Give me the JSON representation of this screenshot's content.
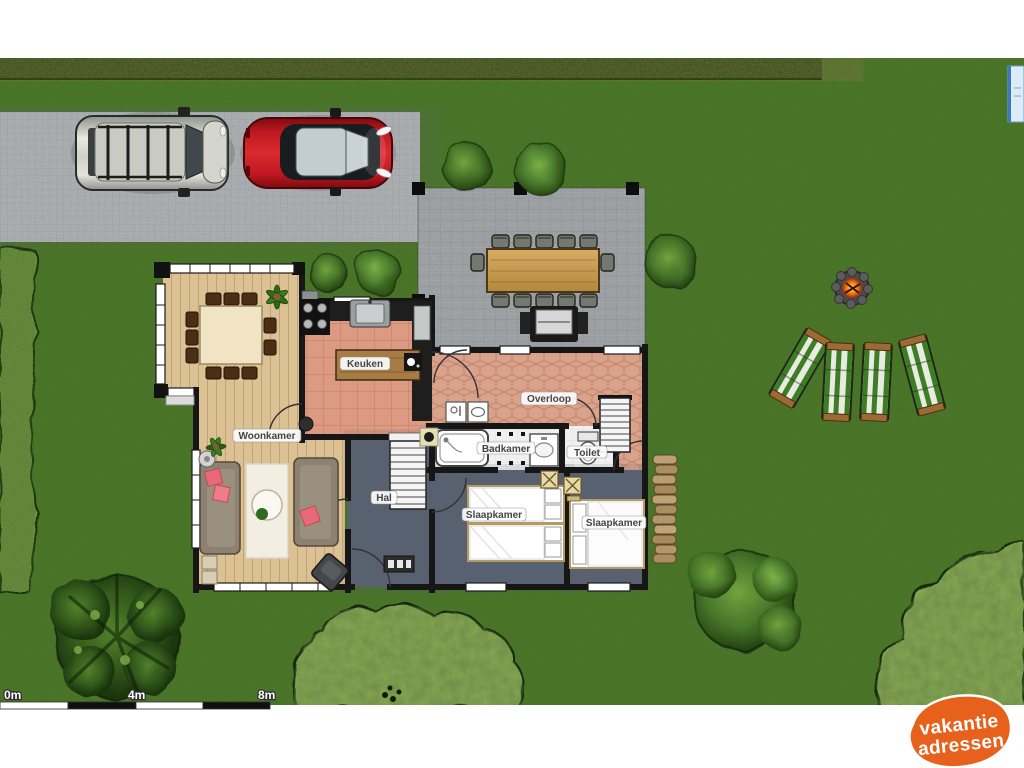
{
  "floorplan": {
    "rooms": {
      "woonkamer": "Woonkamer",
      "keuken": "Keuken",
      "overloop": "Overloop",
      "badkamer": "Badkamer",
      "toilet": "Toilet",
      "slaapkamer_links": "Slaapkamer",
      "slaapkamer_rechts": "Slaapkamer",
      "hal": "Hal"
    },
    "scale_bar": {
      "labels": [
        "0m",
        "4m",
        "8m"
      ]
    }
  },
  "watermark": {
    "line1": "vakantie",
    "line2": "adressen",
    "bg_color": "#e8611c",
    "text_color": "#ffffff"
  },
  "colors": {
    "grass": "#4f7b28",
    "hedge": "#33511b",
    "driveway": "#b6b9bb",
    "terrace": "#a7abae",
    "wood_floor": "#dcc194",
    "kitchen_tiles": "#dd9a82",
    "landing_tiles": "#d9a28b",
    "bathroom_tiles": "#f0f0f0",
    "carpet": "#5a6372",
    "walls": "#161616",
    "car_silver": "#c9cac1",
    "car_red": "#c01820",
    "lounger_green": "#3e7d26",
    "left_border_green": "#6f9440",
    "shrub_green": "#86a851"
  }
}
